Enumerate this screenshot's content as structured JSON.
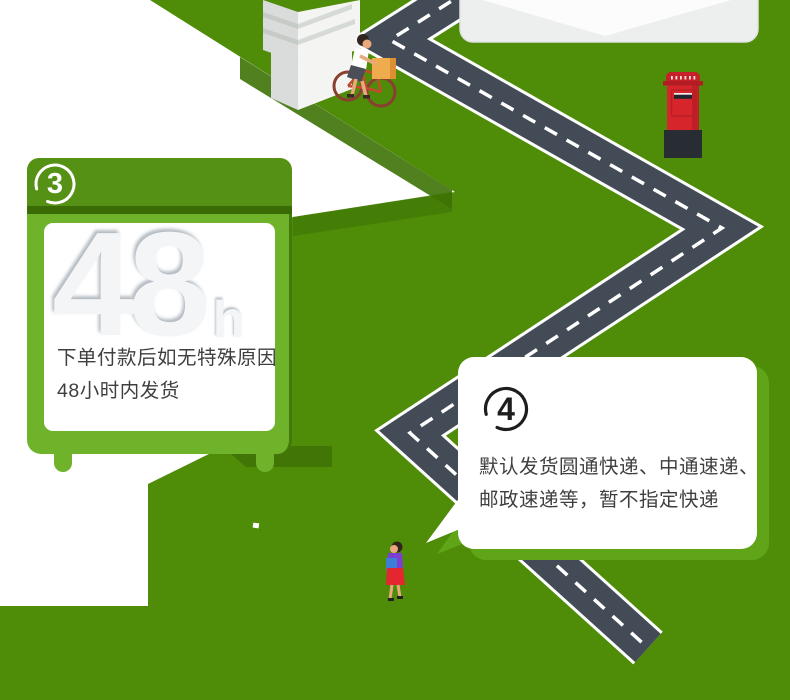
{
  "cards": {
    "step3": {
      "badge": "3",
      "hours_value": "48",
      "hours_unit": "h",
      "line1": "下单付款后如无特殊原因",
      "line2": "48小时内发货"
    },
    "step4": {
      "badge": "4",
      "line1": "默认发货圆通快递、中通速递、",
      "line2": "邮政速递等，暂不指定快递"
    }
  },
  "illustration": {
    "building_icon": "isometric white building plinth, top-left",
    "cyclist_icon": "person on bicycle carrying a package box",
    "road_icon": "dark zigzag road with white dashed center line",
    "envelope_icon": "bottom of white envelope with flap, top-right",
    "postbox_icon": "red pillar mailbox with dark base",
    "pedestrian_icon": "woman in purple top and red skirt walking",
    "path_icon": "white isometric ground path, left side"
  },
  "colors": {
    "background_green": "#4f8c08",
    "shadow_green": "#3e7206",
    "sign_body_green": "#6fb32a",
    "sign_bar_green": "#549114",
    "sign_dark_strip": "#3a6c06",
    "card4_shadow_green": "#5fa517",
    "road_gray": "#424b56",
    "road_marking_white": "#ffffff",
    "postbox_red": "#d7252c",
    "postbox_base": "#282c33",
    "text_dark": "#3f3f3f",
    "embossed_digits": "#f3f5f6"
  }
}
